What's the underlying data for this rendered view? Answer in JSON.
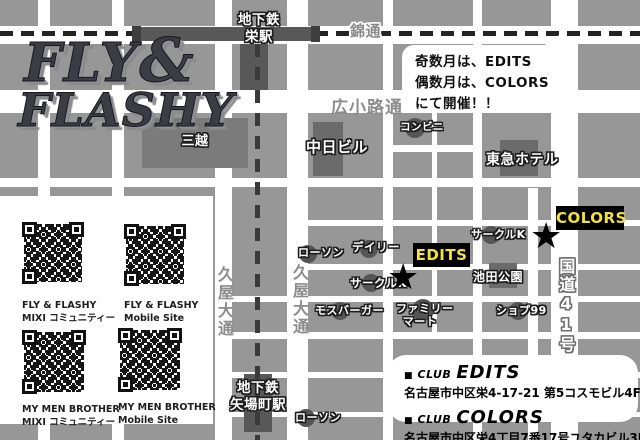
{
  "logo": {
    "fly": "FLY",
    "amp": "&",
    "flashy": "FLASHY"
  },
  "announcement": {
    "line1": "奇数月は、EDITS",
    "line2": "偶数月は、COLORS",
    "line3": "にて開催！！"
  },
  "stations": {
    "sakae_line1": "地下鉄",
    "sakae_line2": "栄駅",
    "yabacho_line1": "地下鉄",
    "yabacho_line2": "矢場町駅"
  },
  "streets": {
    "nishiki": "錦通",
    "hirokoji": "広小路通",
    "hisaya": "久屋大通",
    "route41": "国道41号"
  },
  "landmarks": {
    "mitsukoshi": "三越",
    "chunichi": "中日ビル",
    "conbini": "コンビニ",
    "tokyu_hotel": "東急ホテル",
    "lawson": "ローソン",
    "daily": "デイリー",
    "circle_k": "サークルK",
    "ikeda_park": "池田公園",
    "mos_burger": "モスバーガー",
    "family_mart_line1": "ファミリー",
    "family_mart_line2": "マート",
    "shop99": "ショプ99"
  },
  "venues": {
    "edits": "EDITS",
    "colors": "COLORS"
  },
  "icons": {
    "star": "★",
    "bullet": "■"
  },
  "qr_panel": {
    "items": [
      {
        "title": "FLY & FLASHY",
        "subtitle": "MIXI コミュニティー"
      },
      {
        "title": "FLY & FLASHY",
        "subtitle": "Mobile Site"
      },
      {
        "title": "MY MEN BROTHER",
        "subtitle": "MIXI コミュニティー"
      },
      {
        "title": "MY MEN BROTHER",
        "subtitle": "Mobile Site"
      }
    ]
  },
  "club_info": {
    "entries": [
      {
        "club_word": "CLUB",
        "name": "EDITS",
        "address": "名古屋市中区栄4-17-21 第5コスモビル4F"
      },
      {
        "club_word": "CLUB",
        "name": "COLORS",
        "address": "名古屋市中区栄4丁目7番17号ユタカビル3F"
      }
    ]
  },
  "colors": {
    "venue_label_bg": "#000000",
    "venue_label_text": "#f2e23c",
    "block_gray": "#979797",
    "building_dark": "#6b6b6b",
    "station_dark": "#585858"
  }
}
